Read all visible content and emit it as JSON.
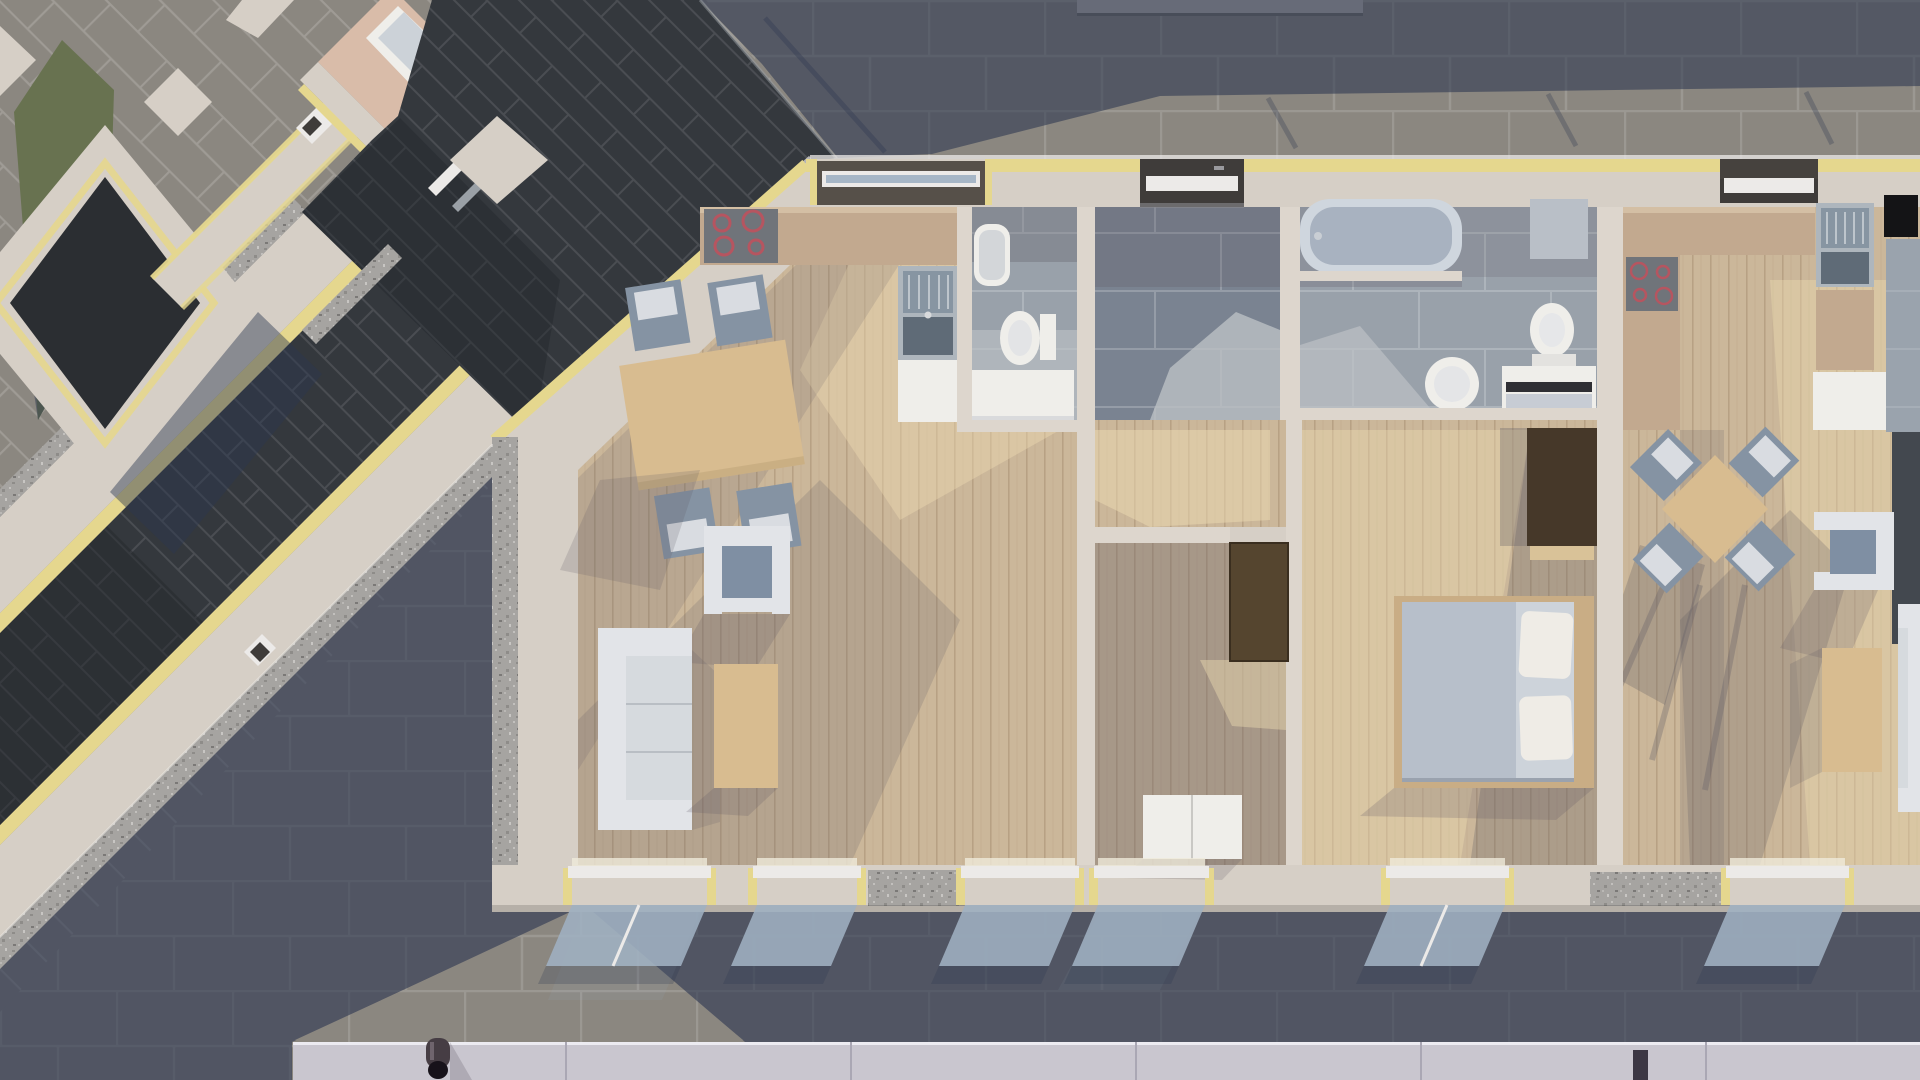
{
  "meta": {
    "kind": "3d-architectural-render",
    "view": "top-down orthographic",
    "subject": "apartment building floor plan with furnished interiors, neighbouring diagonal building, shadowed brick streets",
    "visible_text": "none"
  },
  "palette": {
    "pav": "#8b8780",
    "navy": "#2d3750",
    "ink": "#5e5862",
    "sun": "#eedcb2",
    "green": "#687250",
    "wall": "#d6cfc6",
    "wallLit": "#ddd6cd",
    "yellow": "#e5d78e",
    "roof": "#34383d",
    "roofDark": "#23272c",
    "courtyard": "#2b2e32",
    "pink": "#d9bca9",
    "wood": "#cbb79a",
    "tileHall": "#7a8391",
    "tileBath": "#99a1aa",
    "tileLit": "#bcc0c4",
    "white": "#efeeea",
    "softWhite": "#e2e4e8",
    "cushion": "#d6dade",
    "chair": "#8593a3",
    "seatBlue": "#7f8fa3",
    "tableWood": "#d8bc90",
    "bedFrame": "#c9ad85",
    "counter": "#c2a98f",
    "counterEdge": "#d4bfa4",
    "cooktop": "#70747a",
    "ringRed": "#b65560",
    "steel": "#8795a2",
    "steelBase": "#aeb6bd",
    "basin": "#5f6b77",
    "tub": "#cfd6de",
    "tubInner": "#a8b2c0",
    "duvet": "#b7bfca",
    "sheet": "#cdd3da",
    "pillow": "#efece6",
    "doorBrown": "#55452f",
    "closetBrown": "#463829",
    "closetShelf": "#d9c298",
    "gutter": "#c9c6cf",
    "gutterSeam": "#aaa7b4",
    "pipe": "#463d44",
    "pipeDark": "#17121a",
    "glass": "#9fb0c2",
    "frameWhite": "#eceae8",
    "recessDark": "#3f3c3a",
    "wallCap": "#b8b4b0",
    "capLine": "#6f6c66",
    "grayCab": "#b9bfc7",
    "darkStrip": "#43484f",
    "grayZone": "#9aa3ad",
    "black": "#141416",
    "slate": "#9aa0a6"
  },
  "scene": {
    "street": {
      "paving": "grey brick pavers, running bond; diagonal bond in upper-left block",
      "features": [
        "large diagonal cast shadows",
        "grass strip upper-left",
        "eaves gutter strip along bottom edge",
        "downpipe on gutter",
        "low wall cap along top edge"
      ]
    },
    "diagonal_building": {
      "orientation_deg": 45,
      "elements": [
        "dark inner courtyard",
        "beige insulated walls with yellow insulation strips",
        "dark tiled roof strip between wings",
        "granite rendered wall faces",
        "small room with pink floor and white bathtub",
        "white door frames"
      ]
    },
    "main_building": {
      "walls": "beige render with yellow insulation edge strips and granite sill sections",
      "rooms": [
        {
          "name": "apartment-left living/kitchen",
          "floor": "light wood planks",
          "furniture": [
            "kitchen counter",
            "cooktop with 4 red rings",
            "kitchen sink with drainer",
            "base cabinet",
            "dining table",
            "4 chairs",
            "armchair",
            "3-seat sofa",
            "coffee table"
          ]
        },
        {
          "name": "small bathroom",
          "floor": "grey tiles",
          "furniture": [
            "wall-hung basin",
            "toilet",
            "white vanity"
          ]
        },
        {
          "name": "entry hall",
          "floor": "blue-grey large tiles",
          "furniture": [
            "entrance window/door with white frame"
          ]
        },
        {
          "name": "inner corridor",
          "floor": "wood planks",
          "furniture": [
            "open dark-brown door"
          ]
        },
        {
          "name": "middle room",
          "floor": "wood planks (shadowed)",
          "furniture": [
            "white wardrobe"
          ]
        },
        {
          "name": "main bathroom",
          "floor": "grey tiles",
          "furniture": [
            "bathtub",
            "toilet",
            "pedestal basin",
            "white vanity",
            "grey wall cabinet"
          ]
        },
        {
          "name": "bedroom",
          "floor": "wood planks",
          "furniture": [
            "double bed with grey duvet and two white pillows",
            "dark built-in closet"
          ]
        },
        {
          "name": "apartment-right living/kitchen",
          "floor": "light wood planks",
          "furniture": [
            "L-shaped counter",
            "cooktop with 4 red rings",
            "sink with drainer",
            "tall white unit",
            "black appliance",
            "square dining table rotated 45°",
            "4 chairs",
            "armchair",
            "coffee table",
            "sofa at right edge"
          ]
        }
      ],
      "openings": {
        "north_windows": 3,
        "south_windows": 6,
        "south_window_glazing": "tilted glass panes projecting over pavement"
      }
    }
  }
}
